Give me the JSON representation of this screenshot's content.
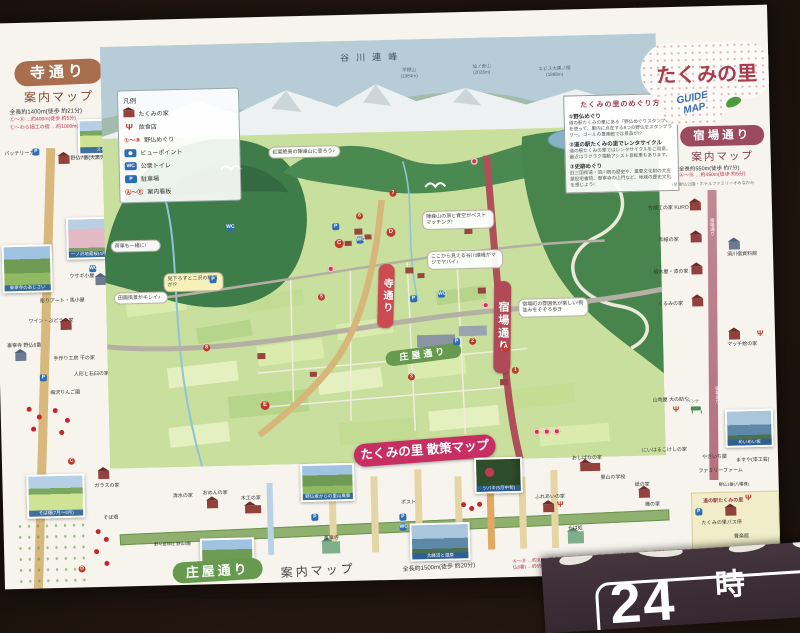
{
  "left_panel": {
    "title": "寺通り",
    "subtitle": "案内マップ",
    "length": "全長約1400m(徒歩 約21分)",
    "dist1": "Ⓒ〜Ⓓ …約400m(徒歩 約5分)",
    "dist2": "Ⓒ〜わら細工の宿 …約1000m(徒歩 約16分)",
    "photos": [
      "スイセン",
      "泰寧寺のあじさい",
      "一ノ沢地蔵桜(4月下旬)",
      "そば畑(7月〜8月)"
    ],
    "spots": [
      "バッテリーカー",
      "野仏7番(大黒天)",
      "ウサギ小屋",
      "彫りアート・馬小屋",
      "ワイン・ぶどうの家",
      "泰寧寺 野仏6番",
      "手作り工房 干の家",
      "人形と石臼の家",
      "梅沢りんご園",
      "ガラスの家",
      "そば畑"
    ]
  },
  "right_panel": {
    "title": "たくみの里",
    "badge_line1": "GUIDE",
    "badge_line2": "MAP",
    "street": "宿場通り",
    "subtitle": "案内マップ",
    "length": "全長約550m(徒歩 約7分)",
    "dist1": "Ⓐ〜Ⓑ …約450m(徒歩 約5分)",
    "note": "↑至 野仏公園・ホテルファミリーオみなかみ",
    "road_label": "宿場通り",
    "photo_caption": "めいめい坂",
    "bench": "ベンチ",
    "spots": [
      "竹細工の家 KURO",
      "和紙の家",
      "須川宿資料館",
      "植木屋・漆の家",
      "くるみの家",
      "マッチ絵の家",
      "山肉屋 大の助や",
      "にいはるこけしの家",
      "ますや(漆工芸)",
      "やきいち屋",
      "ファミリーファーム",
      "野仏1番(八幡様)",
      "道の駅たくみの里",
      "たくみの里バス停",
      "豊楽館"
    ]
  },
  "map": {
    "range": "谷川連峰",
    "peaks": [
      {
        "name": "平標山",
        "elev": "(1984m)"
      },
      {
        "name": "仙ノ倉山",
        "elev": "(2026m)"
      },
      {
        "name": "エビス大黒ノ頭",
        "elev": "(1888m)"
      }
    ],
    "legend": {
      "title": "凡例",
      "items": [
        "たくみの家",
        "飲食店",
        "野仏めぐり",
        "ビューポイント",
        "公衆トイレ",
        "駐車場",
        "案内看板"
      ],
      "range_nums": "①〜⑧",
      "range_letters": "Ⓐ〜Ⓔ",
      "wc": "WC",
      "p": "P"
    },
    "guide": {
      "title": "たくみの里のめぐり方",
      "s1_head": "①野仏めぐり",
      "s1_body": "道の駅たくみの里にある「野仏めぐりスタンプ帳」を使って、里内に点在する8つの野仏をスタンプラリー。ゴールの豊楽館では景品が!?",
      "s2_head": "②道の駅たくみの里でレンタサイクル",
      "s2_body": "道の駅たくみの里ではレンタサイクルをご用意。最近はラクラク電動アシスト自転車もあります。",
      "s3_head": "③史跡めぐり",
      "s3_body": "旧三国街道・須川宿の歴史や、重要文化財の大庄屋役宅書院、泰寧寺の山門など、地域の歴史文化を感じよう!"
    },
    "banner_tera": "寺通り",
    "banner_shukuba": "宿場通り",
    "banner_shoya": "庄屋通り",
    "main_banner": "たくみの里 散策マップ",
    "callouts": [
      "紅葉絶景の陣峰山に登ろう♪",
      "陣峰山の頂と青空がベストマッチング!",
      "ここから見える谷川連峰がマジでヤバイ♪",
      "宿場町の雰囲気が楽しい!街並みをそぞろ歩き",
      "荷車も一緒に!",
      "田園風景がキレイ♪",
      "見下ろすと二沢の棚田が!?"
    ]
  },
  "bottom_panel": {
    "title": "庄屋通り",
    "subtitle": "案内マップ",
    "length": "全長約1500m(徒歩 約20分)",
    "dists": "Ⓐ〜Ⓑ …約300m(徒歩 約4分)　Ⓑ〜Ⓓ …約550m(徒歩 約8分)　Ⓔ〜郷平宮神社(野仏8番) …約650m(徒歩 約10分)",
    "photos": [
      "野仏坂からの里山風景",
      "泰寧寺とあじさい",
      "ツバキ(5月中旬)",
      "大峰沼と湿原"
    ],
    "spots": [
      "清水の家",
      "おめんの家",
      "木工の家",
      "野々宮神社 野仏4番",
      "泰寧寺",
      "ポスト",
      "ふれあいの家",
      "そば処",
      "おしばなの家",
      "里山の学校",
      "紙の家",
      "織の家"
    ]
  },
  "sign": {
    "big": "24",
    "unit": "時"
  },
  "markers": {
    "letters": [
      "A",
      "B",
      "C",
      "D",
      "E"
    ],
    "numbers": [
      "1",
      "2",
      "3",
      "4",
      "5",
      "6",
      "7",
      "8"
    ]
  }
}
